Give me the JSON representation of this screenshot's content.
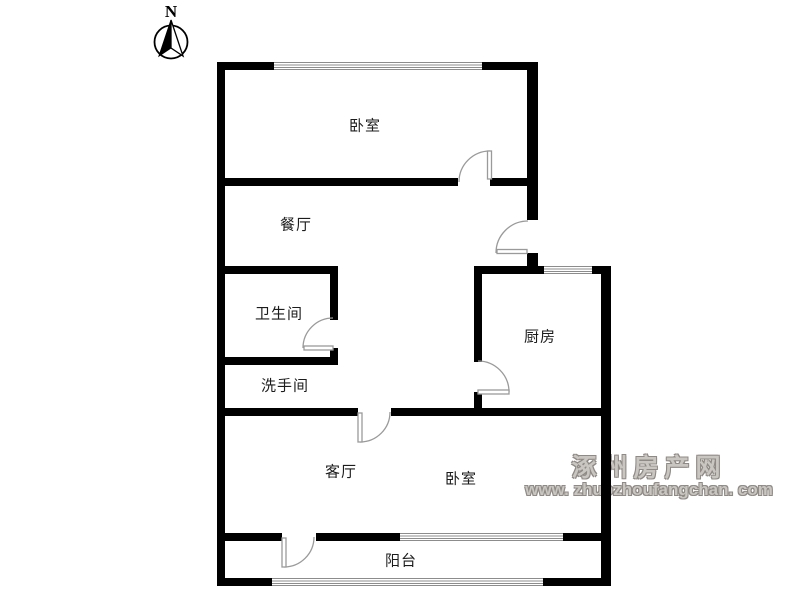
{
  "compass": {
    "label": "N"
  },
  "rooms": [
    {
      "id": "bedroom-top",
      "label": "卧室"
    },
    {
      "id": "dining-room",
      "label": "餐厅"
    },
    {
      "id": "bathroom",
      "label": "卫生间"
    },
    {
      "id": "washroom",
      "label": "洗手间"
    },
    {
      "id": "kitchen",
      "label": "厨房"
    },
    {
      "id": "living-room",
      "label": "客厅"
    },
    {
      "id": "bedroom-bottom",
      "label": "卧室"
    },
    {
      "id": "balcony",
      "label": "阳台"
    }
  ],
  "watermark": {
    "site_name": "涿州房产网",
    "site_url": "www. zhuozhoufangchan. com"
  },
  "colors": {
    "wall": "#000000",
    "door": "#9a9a9a",
    "window_line": "#8c8c8c",
    "watermark_gray": "#8f8a85"
  }
}
